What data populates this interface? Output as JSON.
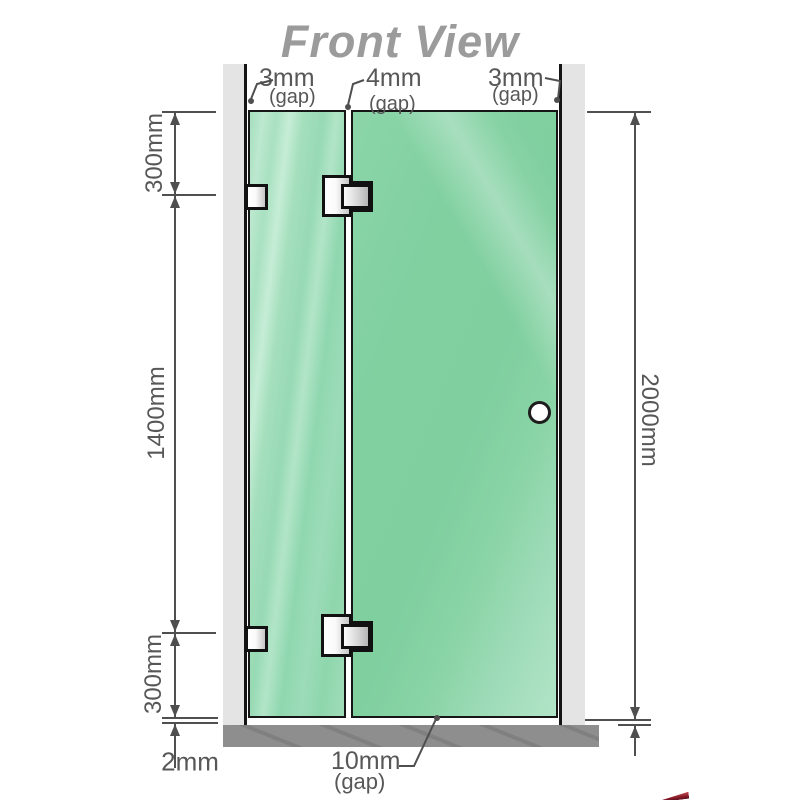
{
  "title": "Front View",
  "top_gaps": [
    {
      "value": "3mm",
      "unit": "(gap)"
    },
    {
      "value": "4mm",
      "unit": "(gap)"
    },
    {
      "value": "3mm",
      "unit": "(gap)"
    }
  ],
  "dimensions": {
    "left_top": "300mm",
    "left_middle": "1400mm",
    "left_bottom": "300mm",
    "right_total": "2000mm",
    "base_thickness": "2mm",
    "bottom_gap_value": "10mm",
    "bottom_gap_unit": "(gap)"
  },
  "colors": {
    "glass_green": "#80d0a0",
    "glass_light_green": "#b2e5c8",
    "wall_gray": "#e4e4e4",
    "base_gray": "#8e8e8e",
    "dimension_gray": "#4f4f4f",
    "title_gray": "#9b9b9b",
    "accent_red": "#7d1626"
  }
}
